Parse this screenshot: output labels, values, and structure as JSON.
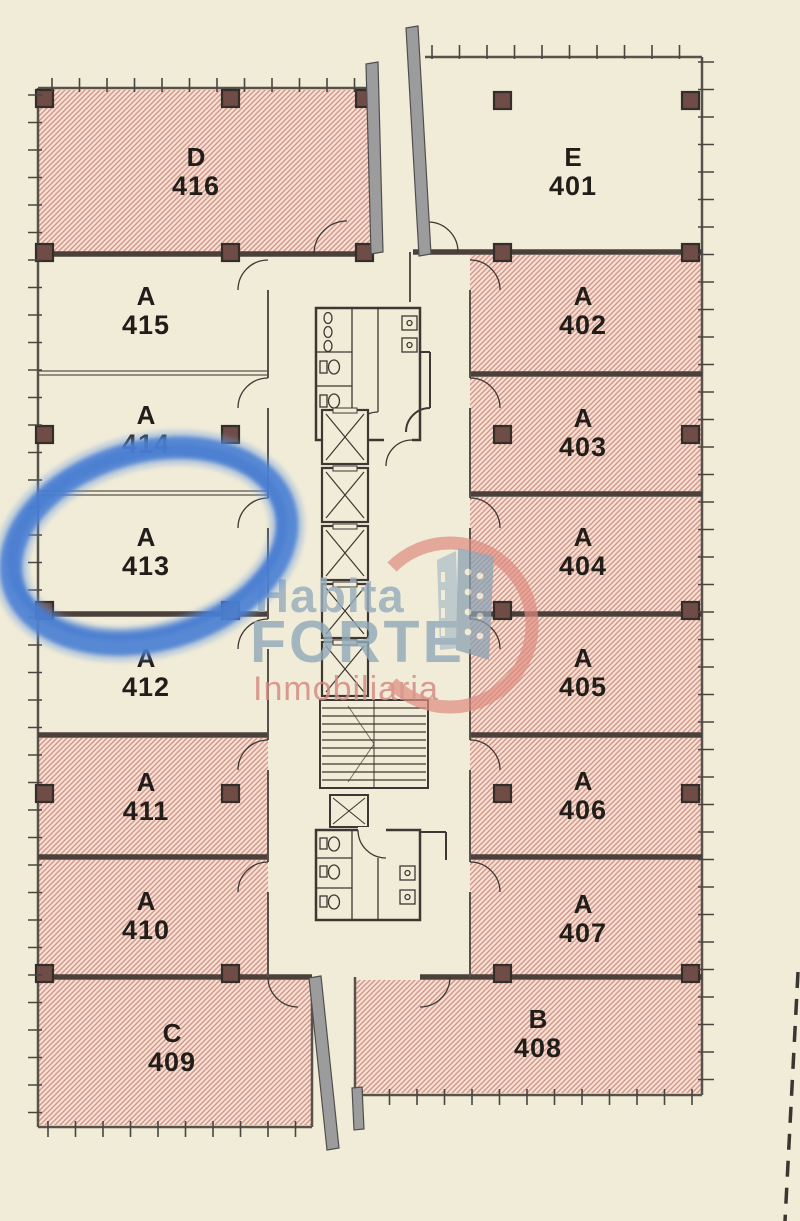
{
  "plan": {
    "type": "office-floor-plan",
    "units": [
      {
        "id": "D-416",
        "letter": "D",
        "number": "416",
        "hatched": true
      },
      {
        "id": "A-415",
        "letter": "A",
        "number": "415",
        "hatched": false
      },
      {
        "id": "A-414",
        "letter": "A",
        "number": "414",
        "hatched": false
      },
      {
        "id": "A-413",
        "letter": "A",
        "number": "413",
        "hatched": false
      },
      {
        "id": "A-412",
        "letter": "A",
        "number": "412",
        "hatched": false
      },
      {
        "id": "A-411",
        "letter": "A",
        "number": "411",
        "hatched": true
      },
      {
        "id": "A-410",
        "letter": "A",
        "number": "410",
        "hatched": true
      },
      {
        "id": "C-409",
        "letter": "C",
        "number": "409",
        "hatched": true
      },
      {
        "id": "E-401",
        "letter": "E",
        "number": "401",
        "hatched": false
      },
      {
        "id": "A-402",
        "letter": "A",
        "number": "402",
        "hatched": true
      },
      {
        "id": "A-403",
        "letter": "A",
        "number": "403",
        "hatched": true
      },
      {
        "id": "A-404",
        "letter": "A",
        "number": "404",
        "hatched": true
      },
      {
        "id": "A-405",
        "letter": "A",
        "number": "405",
        "hatched": true
      },
      {
        "id": "A-406",
        "letter": "A",
        "number": "406",
        "hatched": true
      },
      {
        "id": "A-407",
        "letter": "A",
        "number": "407",
        "hatched": true
      },
      {
        "id": "B-408",
        "letter": "B",
        "number": "408",
        "hatched": true
      }
    ]
  },
  "annotation": {
    "shape": "hand-drawn-ellipse",
    "highlighted_unit": "A 413",
    "color": "#4a80d4"
  },
  "watermark": {
    "line1": "Habita",
    "line2": "FORTE",
    "line3": "Inmobiliaria"
  },
  "colors": {
    "background": "#f1ecd8",
    "hatch_line": "#d59486",
    "hatch_fill": "#f5e2d7",
    "wall_dark": "#4c403b",
    "wall_light": "#57524b",
    "column_fill": "#6f4c46",
    "mullion_gray": "#9c9c9c",
    "watermark_blue": "#92a9ba",
    "watermark_red": "#d5887f",
    "highlight_blue": "#4a80d4"
  }
}
